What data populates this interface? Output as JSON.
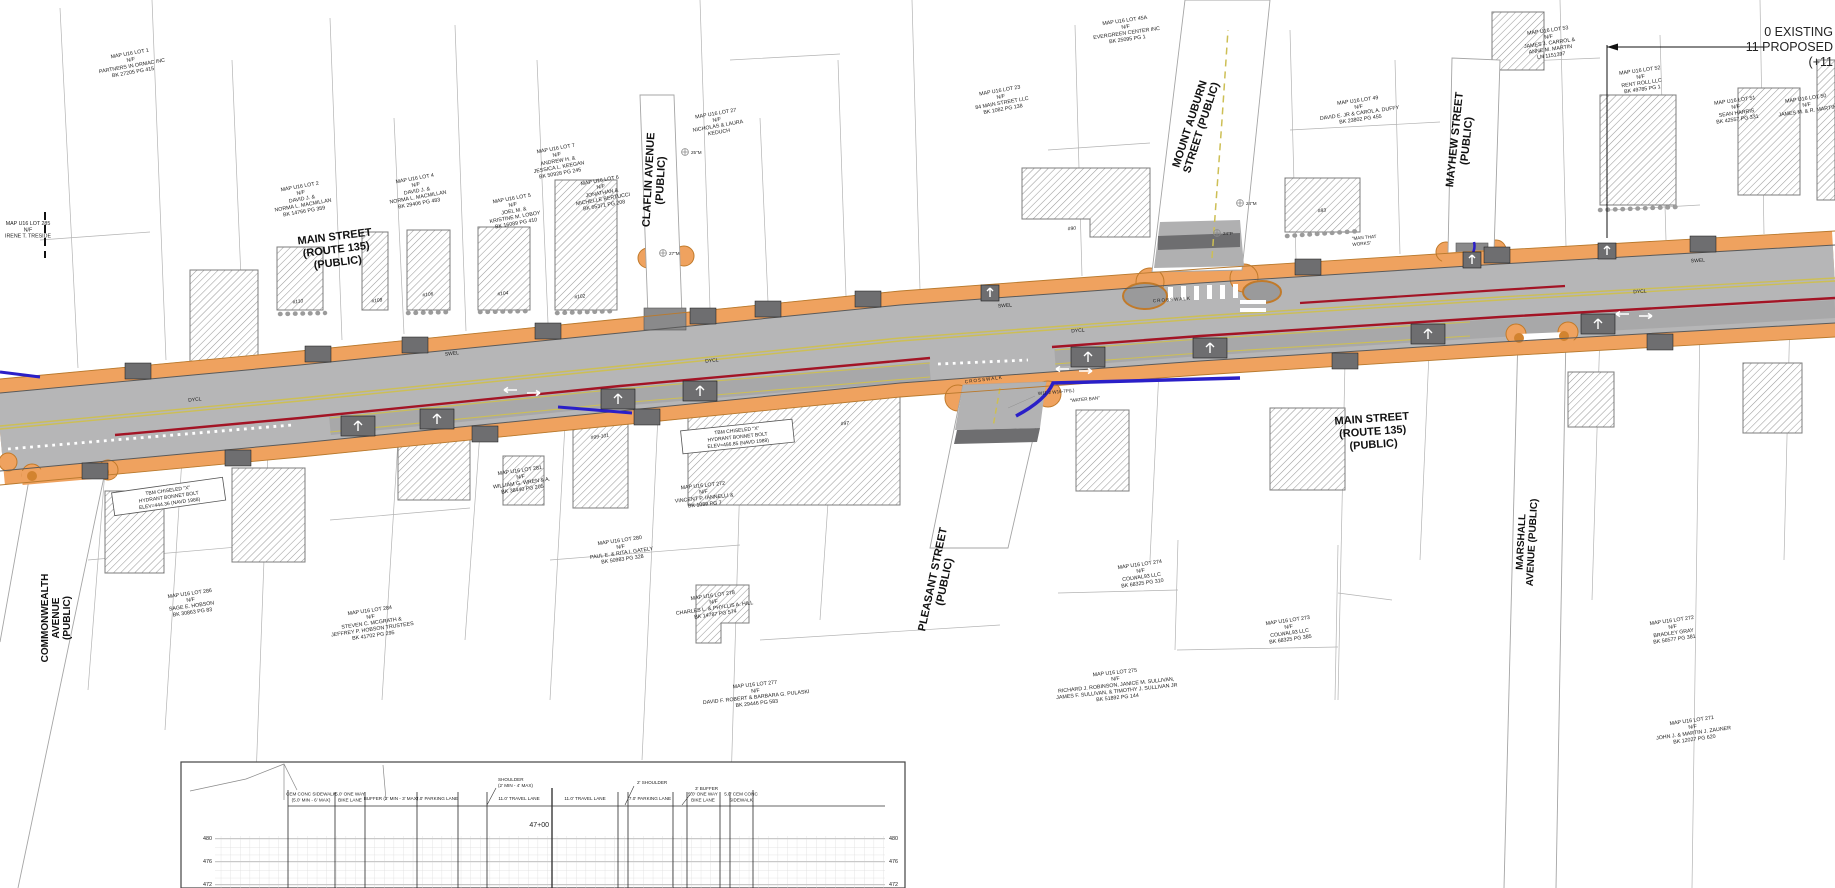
{
  "note": {
    "lines": [
      "0 EXISTING",
      "11 PROPOSED",
      "(+11"
    ]
  },
  "streets": {
    "main_west": {
      "lines": [
        "MAIN STREET",
        "(ROUTE 135)",
        "(PUBLIC)"
      ]
    },
    "main_east": {
      "lines": [
        "MAIN STREET",
        "(ROUTE 135)",
        "(PUBLIC)"
      ]
    },
    "claflin": {
      "lines": [
        "CLAFLIN AVENUE",
        "(PUBLIC)"
      ]
    },
    "mount_auburn": {
      "lines": [
        "MOUNT AUBURN",
        "STREET (PUBLIC)"
      ]
    },
    "mayhew": {
      "lines": [
        "MAYHEW STREET",
        "(PUBLIC)"
      ]
    },
    "commonwealth": {
      "lines": [
        "COMMONWEALTH",
        "AVENUE",
        "(PUBLIC)"
      ]
    },
    "pleasant": {
      "lines": [
        "PLEASANT STREET",
        "(PUBLIC)"
      ]
    },
    "marshall": {
      "lines": [
        "MARSHALL",
        "AVENUE (PUBLIC)"
      ]
    }
  },
  "road_labels": {
    "dycl": "DYCL",
    "swel": "SWEL",
    "crosswalk": "CROSSWALK",
    "sign_codes": "W11-2  W16-7P(L)",
    "water_ban": "\"WATER BAN\"",
    "man_that_works": [
      "\"MAN THAT",
      "WORKS\""
    ]
  },
  "benchmarks": [
    {
      "lines": [
        "TBM CHISELED \"X\"",
        "HYDRANT BONNET BOLT",
        "ELEV=444.36 (NAVD 1988)"
      ]
    },
    {
      "lines": [
        "TBM CHISELED \"X\"",
        "HYDRANT BONNET BOLT",
        "ELEV=456.85 (NAVD 1988)"
      ]
    }
  ],
  "tree_tags": [
    "25\"M",
    "27\"M",
    "24\"M",
    "24\"P"
  ],
  "buildings": [
    "#110",
    "#108",
    "#106",
    "#104",
    "#102",
    "#99-101",
    "#97",
    "#90",
    "#83"
  ],
  "parcels": [
    {
      "lines": [
        "MAP U16 LOT 1",
        "N/F",
        "PARTNERS IN ORMAC INC",
        "BK 27205 PG 415"
      ]
    },
    {
      "lines": [
        "MAP U16 LOT 285",
        "N/F",
        "IRENE T. TRESIDE"
      ]
    },
    {
      "lines": [
        "MAP U16 LOT 2",
        "N/F",
        "DAVID J. &",
        "NORMA L. MACMILLAN",
        "BK 14766 PG 359"
      ]
    },
    {
      "lines": [
        "MAP U16 LOT 4",
        "N/F",
        "DAVID J. &",
        "NORMA L. MACMILLAN",
        "BK 29406 PG 483"
      ]
    },
    {
      "lines": [
        "MAP U16 LOT 5",
        "N/F",
        "JOEL M. &",
        "KRISTINE M. LOBOY",
        "BK 16089 PG 410"
      ]
    },
    {
      "lines": [
        "MAP U16 LOT 6",
        "N/F",
        "JONATHAN &",
        "MICHELLE BERTUCCI",
        "BK 65371 PG 208"
      ]
    },
    {
      "lines": [
        "MAP U16 LOT 7",
        "N/F",
        "ANDREW H. &",
        "JESSICA L. KEEGAN",
        "BK 50928 PG 245"
      ]
    },
    {
      "lines": [
        "MAP U16 LOT 27",
        "N/F",
        "NICHOLAS & LAURA",
        "KEDUCH"
      ]
    },
    {
      "lines": [
        "MAP U16 LOT 23",
        "N/F",
        "84 MAIN STREET LLC",
        "BK 1082 PG 138"
      ]
    },
    {
      "lines": [
        "MAP U16 LOT 45A",
        "N/F",
        "EVERGREEN CENTER INC",
        "BK 25095 PG 1"
      ]
    },
    {
      "lines": [
        "MAP U16 LOT 49",
        "N/F",
        "DAVID E. JR & CAROL A. DUFFY",
        "BK 23802 PG 455"
      ]
    },
    {
      "lines": [
        "MAP U16 LOT 53",
        "N/F",
        "JAMES J. CARROL &",
        "ANNE M. MARTIN",
        "LN 1151397"
      ]
    },
    {
      "lines": [
        "MAP U16 LOT 52",
        "N/F",
        "RENT ROLL LLC",
        "BK 49785 PG 1"
      ]
    },
    {
      "lines": [
        "MAP U16 LOT 51",
        "N/F",
        "SEAN HARRIS",
        "BK 42557 PG 331"
      ]
    },
    {
      "lines": [
        "MAP U16 LOT 50",
        "N/F",
        "JAMES M. & R. MARTIN"
      ]
    },
    {
      "lines": [
        "MAP U16 LOT 281",
        "N/F",
        "WILLIAM G. WREN & A.",
        "BK 38440 PG 205"
      ]
    },
    {
      "lines": [
        "MAP U16 LOT 272",
        "N/F",
        "VINCENT P. IANNELLI &",
        "BK 1089 PG 7"
      ]
    },
    {
      "lines": [
        "MAP U16 LOT 280",
        "N/F",
        "PAUL E. & RITA I. GATELY",
        "BK 50983 PG 328"
      ]
    },
    {
      "lines": [
        "MAP U16 LOT 278",
        "N/F",
        "CHARLES L. & PHYLLIS A. HILL",
        "BK 14787 PG 574"
      ]
    },
    {
      "lines": [
        "MAP U16 LOT 284",
        "N/F",
        "STEVEN C. MCGRATH &",
        "JEFFREY P. HOBSON TRUSTEES",
        "BK 41702 PG 295"
      ]
    },
    {
      "lines": [
        "MAP U16 LOT 286",
        "N/F",
        "SAGE E. HOBSON",
        "BK 30863 PG 83"
      ]
    },
    {
      "lines": [
        "MAP U16 LOT 277",
        "N/F",
        "DAVID F. ROBERT & BARBARA G. PULASKI",
        "BK 29446 PG 583"
      ]
    },
    {
      "lines": [
        "MAP U16 LOT 274",
        "N/F",
        "COLWAL93 LLC",
        "BK 68325 PG 310"
      ]
    },
    {
      "lines": [
        "MAP U16 LOT 273",
        "N/F",
        "COLWAL93 LLC",
        "BK 68325 PG 385"
      ]
    },
    {
      "lines": [
        "MAP U16 LOT 275",
        "N/F",
        "RICHARD J. ROBINSON, JANICE M. SULLIVAN,",
        "JAMES F. SULLIVAN, & TIMOTHY J. SULLIVAN JR",
        "BK 51892 PG 144"
      ]
    },
    {
      "lines": [
        "MAP U16 LOT 272",
        "N/F",
        "BRADLEY GRAY",
        "BK 56577 PG 381"
      ]
    },
    {
      "lines": [
        "MAP U16 LOT 271",
        "N/F",
        "JOHN J. & MARTIN J. ZAUNER",
        "BK 12027 PG 620"
      ]
    }
  ],
  "cross_section": {
    "station": "47+00",
    "elevations": [
      "480",
      "476",
      "472"
    ],
    "left_labels": {
      "sidewalk": [
        "CEM CONC SIDEWALK",
        "(5.0' MIN - 6' MAX)"
      ],
      "bike": [
        "5.0' ONE WAY",
        "BIKE LANE"
      ],
      "buffer": "BUFFER (2' MIN - 3' MAX)",
      "parking": "7.0' PARKING LANE",
      "shoulder": [
        "SHOULDER",
        "(2' MIN - 4' MAX)"
      ],
      "travel": "11.0' TRAVEL LANE"
    },
    "right_labels": {
      "travel": "11.0' TRAVEL LANE",
      "shoulder": "2' SHOULDER",
      "parking": "7.0' PARKING LANE",
      "buffer": "3' BUFFER",
      "bike": [
        "5.0' ONE WAY",
        "BIKE LANE"
      ],
      "sidewalk": [
        "5.0' CEM CONC",
        "SIDEWALK"
      ]
    }
  },
  "colors": {
    "sidewalk_orange": "#efa25f",
    "curb_orange": "#b97a2e",
    "asphalt": "#b6b6b7",
    "parking_gray": "#a8a8a9",
    "apron_gray": "#6e6e70",
    "centerline_yellow": "#cdbf55",
    "edge_red": "#a31425",
    "utility_blue": "#2a1fc8"
  }
}
